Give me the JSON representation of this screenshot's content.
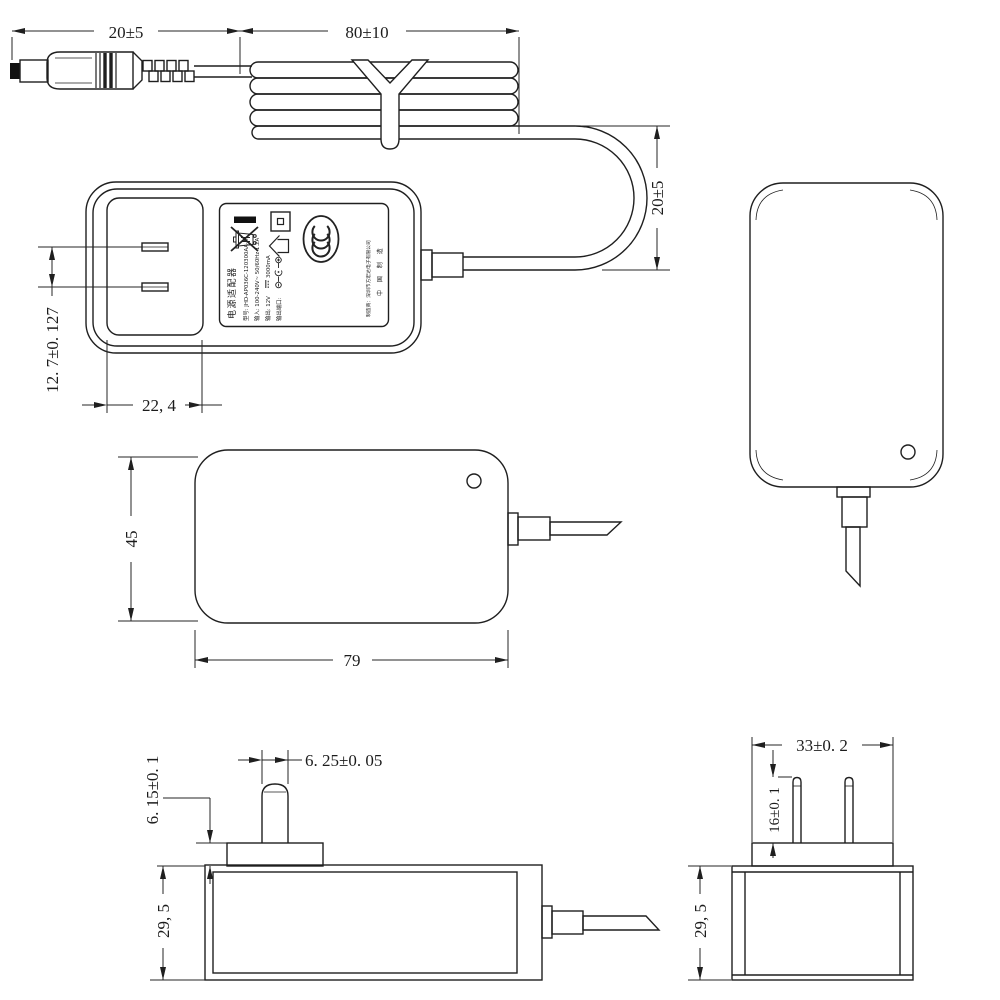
{
  "drawing": {
    "background": "#ffffff",
    "line_color": "#1f1f1f",
    "dimensions": {
      "plug_length": "20±5",
      "coil_length": "80±10",
      "loop_height": "20±5",
      "blade_pitch": "12. 7±0. 127",
      "plug_base_width": "22, 4",
      "front_height": "45",
      "front_width": "79",
      "blade_width": "6. 25±0. 05",
      "base_height": "6. 15±0. 1",
      "body_depth_side": "29, 5",
      "base_width_end": "33±0. 2",
      "blade_length": "16±0. 1",
      "body_depth_end": "29, 5"
    },
    "label": {
      "title": "电源适配器",
      "model": "型号: JHD-AP036C-120300AA-A",
      "input": "输入: 100-240V~ 50/60Hz 1.2A",
      "output_prefix": "输出: 12V",
      "output_suffix": "3000mA",
      "port": "输出端口:",
      "manufacturer": "制造商：深圳市方宏达电子有限公司",
      "made_in": "中 国 制 造",
      "icons": [
        "weee-bin-icon",
        "black-bar-icon",
        "indoor-use-icon",
        "class-ii-icon",
        "ccc-mark-icon",
        "polarity-icon",
        "dc-symbol-icon"
      ]
    }
  }
}
